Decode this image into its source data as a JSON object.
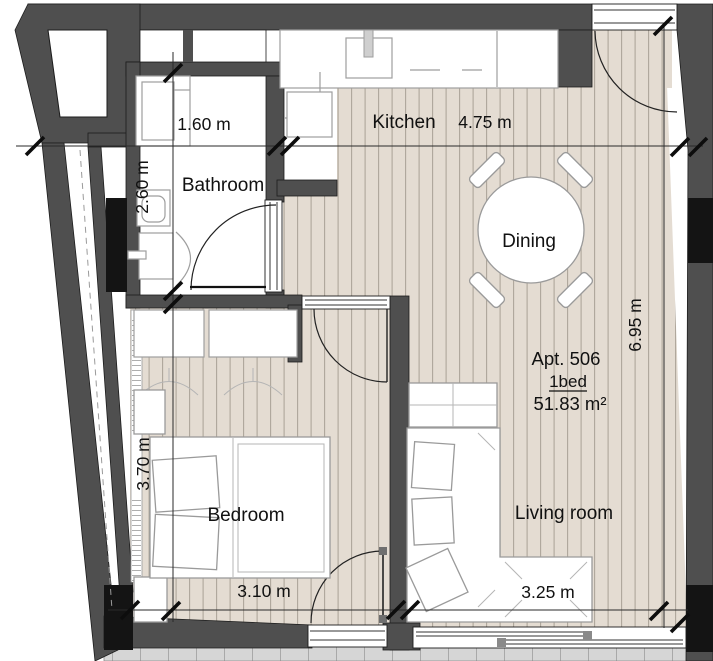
{
  "plan": {
    "apartment": {
      "number": "Apt. 506",
      "type": "1bed",
      "area": "51.83 m²"
    },
    "rooms": {
      "kitchen": "Kitchen",
      "bathroom": "Bathroom",
      "bedroom": "Bedroom",
      "living_room": "Living room",
      "dining": "Dining"
    },
    "dimensions": {
      "bathroom_width": "1.60 m",
      "bathroom_depth": "2.60 m",
      "kitchen_width": "4.75 m",
      "overall_depth": "6.95 m",
      "bedroom_depth": "3.70 m",
      "bedroom_width": "3.10 m",
      "living_width": "3.25 m"
    },
    "colors": {
      "wall": "#4f4f4f",
      "floor": "#e4dcd2",
      "floor_stripe": "#aea69a",
      "balcony": "#d6d6d6",
      "accent_black": "#141414"
    }
  }
}
